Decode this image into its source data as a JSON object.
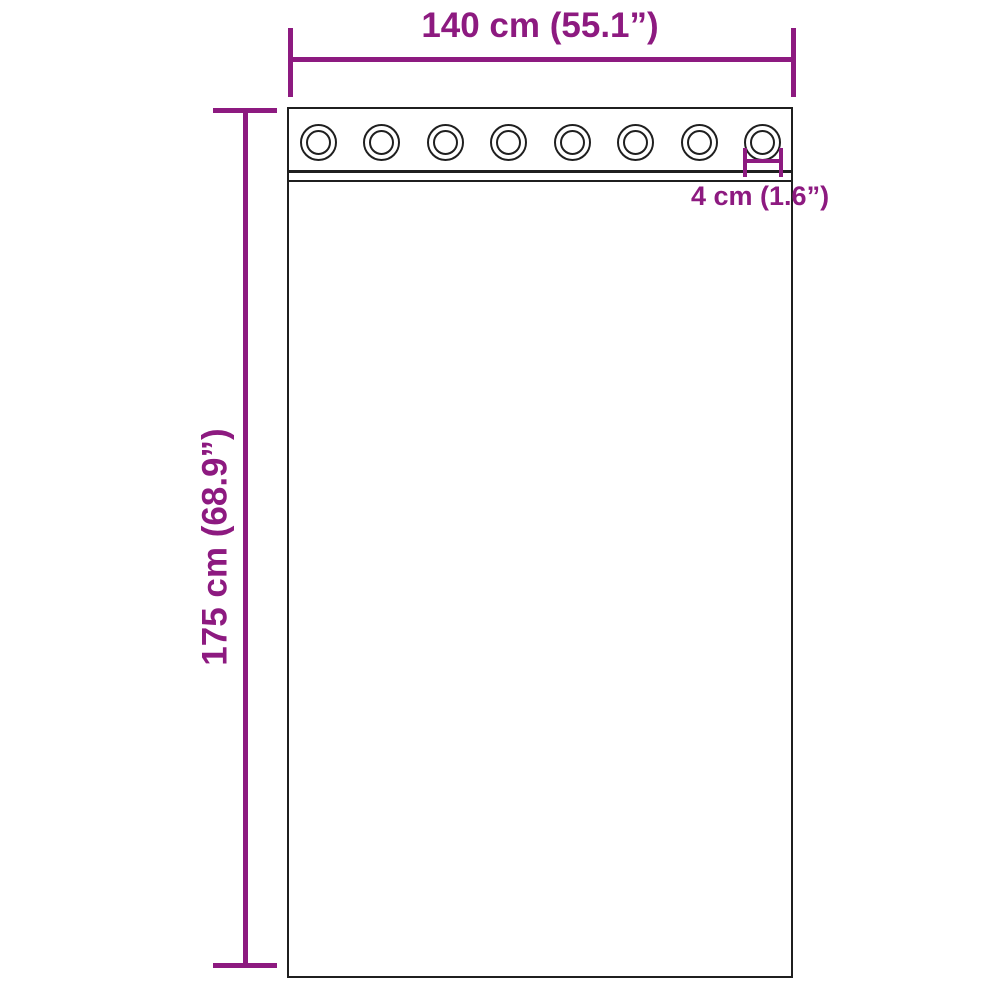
{
  "diagram": {
    "type": "product-dimension-diagram",
    "subject": "curtain panel with grommets",
    "width_label": "140 cm (55.1”)",
    "height_label": "175 cm (68.9”)",
    "grommet_size_label": "4 cm (1.6”)",
    "grommet_count": 8,
    "colors": {
      "dimension_accent": "#8d1a80",
      "outline": "#1f1f1f",
      "background": "#ffffff"
    }
  }
}
